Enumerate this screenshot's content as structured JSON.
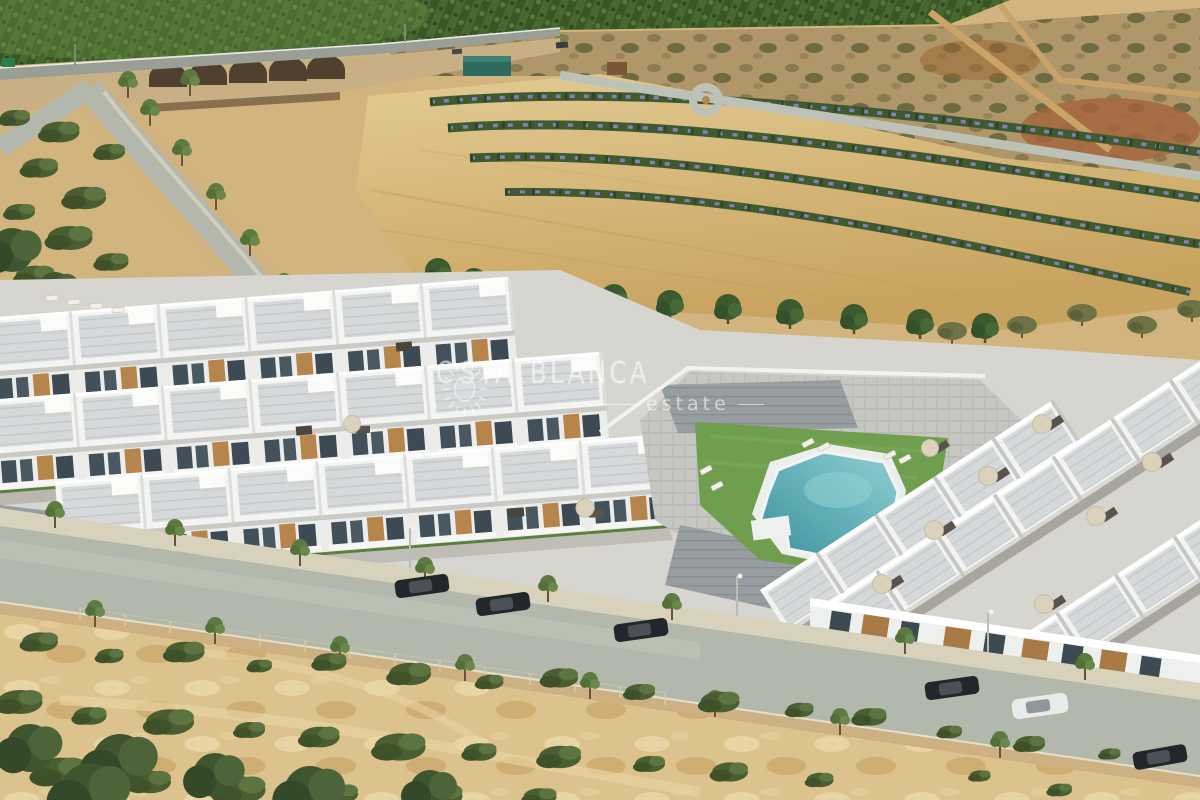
{
  "watermark": {
    "brand_prefix": "C",
    "brand_mid": "STA",
    "brand_end": "BLANCA",
    "tagline": "estate",
    "color": "#ffffff"
  },
  "scene": {
    "type": "aerial-3d-render",
    "subject": "new-build residential development of white villas with rooftop terraces and a communal pool, beside a street with parked cars, surrounded by orchards, dirt fields and scrubland",
    "regions": [
      {
        "name": "orchard-hillside",
        "color": "#46682e"
      },
      {
        "name": "arched-stone-bridge",
        "color": "#c9b084"
      },
      {
        "name": "highway-road",
        "color": "#999f96"
      },
      {
        "name": "brown-scrub-slope",
        "color": "#b0976a"
      },
      {
        "name": "sand-field",
        "color": "#d4b57c"
      },
      {
        "name": "flower-hedge-rows",
        "color": "#3d5a31",
        "accent": "#8a7cb5"
      },
      {
        "name": "pine-tree-row",
        "color": "#3c5a2e"
      },
      {
        "name": "white-residential-complex",
        "color": "#f3f4f1"
      },
      {
        "name": "rooftop-terraces",
        "color": "#d3d6d8"
      },
      {
        "name": "wood-facade-panels",
        "color": "#b5854c"
      },
      {
        "name": "communal-pool",
        "color": "#48a0a8"
      },
      {
        "name": "lawn",
        "color": "#6f9e4f"
      },
      {
        "name": "street",
        "color": "#b2b8ab"
      },
      {
        "name": "foreground-scrubland",
        "color": "#dcc28c",
        "bush_color": "#4a5e31"
      }
    ],
    "cars": [
      {
        "color": "#22262a"
      },
      {
        "color": "#2c3136"
      },
      {
        "color": "#24282c"
      },
      {
        "color": "#1f2326"
      },
      {
        "color": "#e9ebe9"
      },
      {
        "color": "#26292d"
      }
    ]
  }
}
